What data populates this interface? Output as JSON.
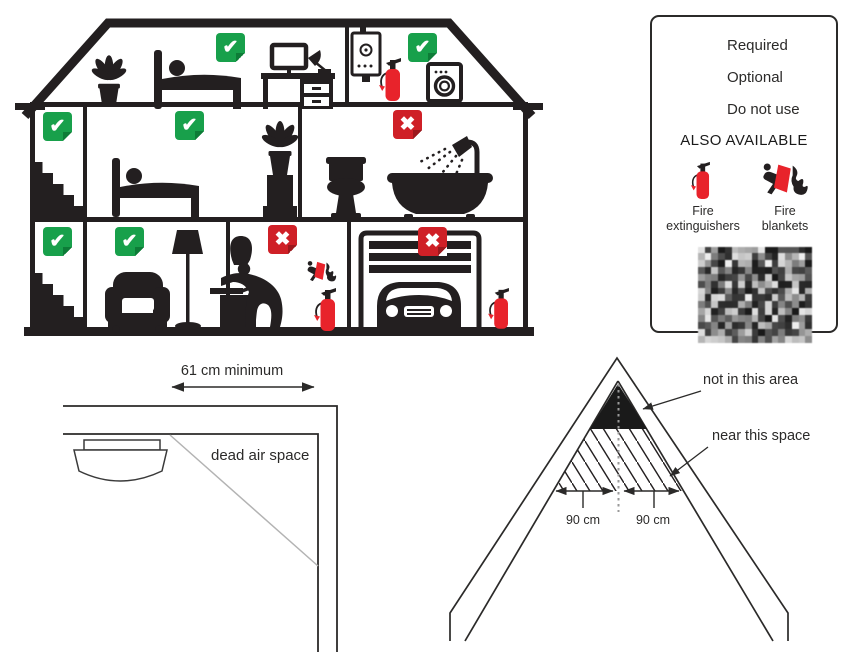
{
  "colors": {
    "required_green": "#18a04b",
    "optional_orange": "#e49b2d",
    "do_not_use_red": "#cf2027",
    "silhouette_black": "#231f20",
    "extinguisher_red": "#e8232b"
  },
  "glyphs": {
    "check": "✔",
    "cross": "✖"
  },
  "legend": {
    "items": [
      {
        "label": "Required",
        "type": "required"
      },
      {
        "label": "Optional",
        "type": "optional"
      },
      {
        "label": "Do not use",
        "type": "do_not_use"
      }
    ],
    "also_available": "ALSO AVAILABLE",
    "products": [
      {
        "line1": "Fire",
        "line2": "extinguishers",
        "icon": "fire-extinguisher-icon"
      },
      {
        "line1": "Fire",
        "line2": "blankets",
        "icon": "fire-blanket-icon"
      }
    ]
  },
  "house": {
    "markers": [
      {
        "room": "attic-bedroom",
        "type": "required"
      },
      {
        "room": "attic-utility-room",
        "type": "required"
      },
      {
        "room": "middle-stairwell",
        "type": "required"
      },
      {
        "room": "middle-bedroom",
        "type": "required"
      },
      {
        "room": "bathroom",
        "type": "do_not_use"
      },
      {
        "room": "ground-stairwell",
        "type": "required"
      },
      {
        "room": "living-room",
        "type": "required"
      },
      {
        "room": "kitchen",
        "type": "do_not_use"
      },
      {
        "room": "garage",
        "type": "do_not_use"
      }
    ]
  },
  "ceiling_diagram": {
    "measurement_label": "61 cm minimum",
    "area_label": "dead air space"
  },
  "attic_diagram": {
    "no_area_label": "not in this area",
    "near_label": "near this space",
    "left_measurement": "90 cm",
    "right_measurement": "90 cm"
  }
}
